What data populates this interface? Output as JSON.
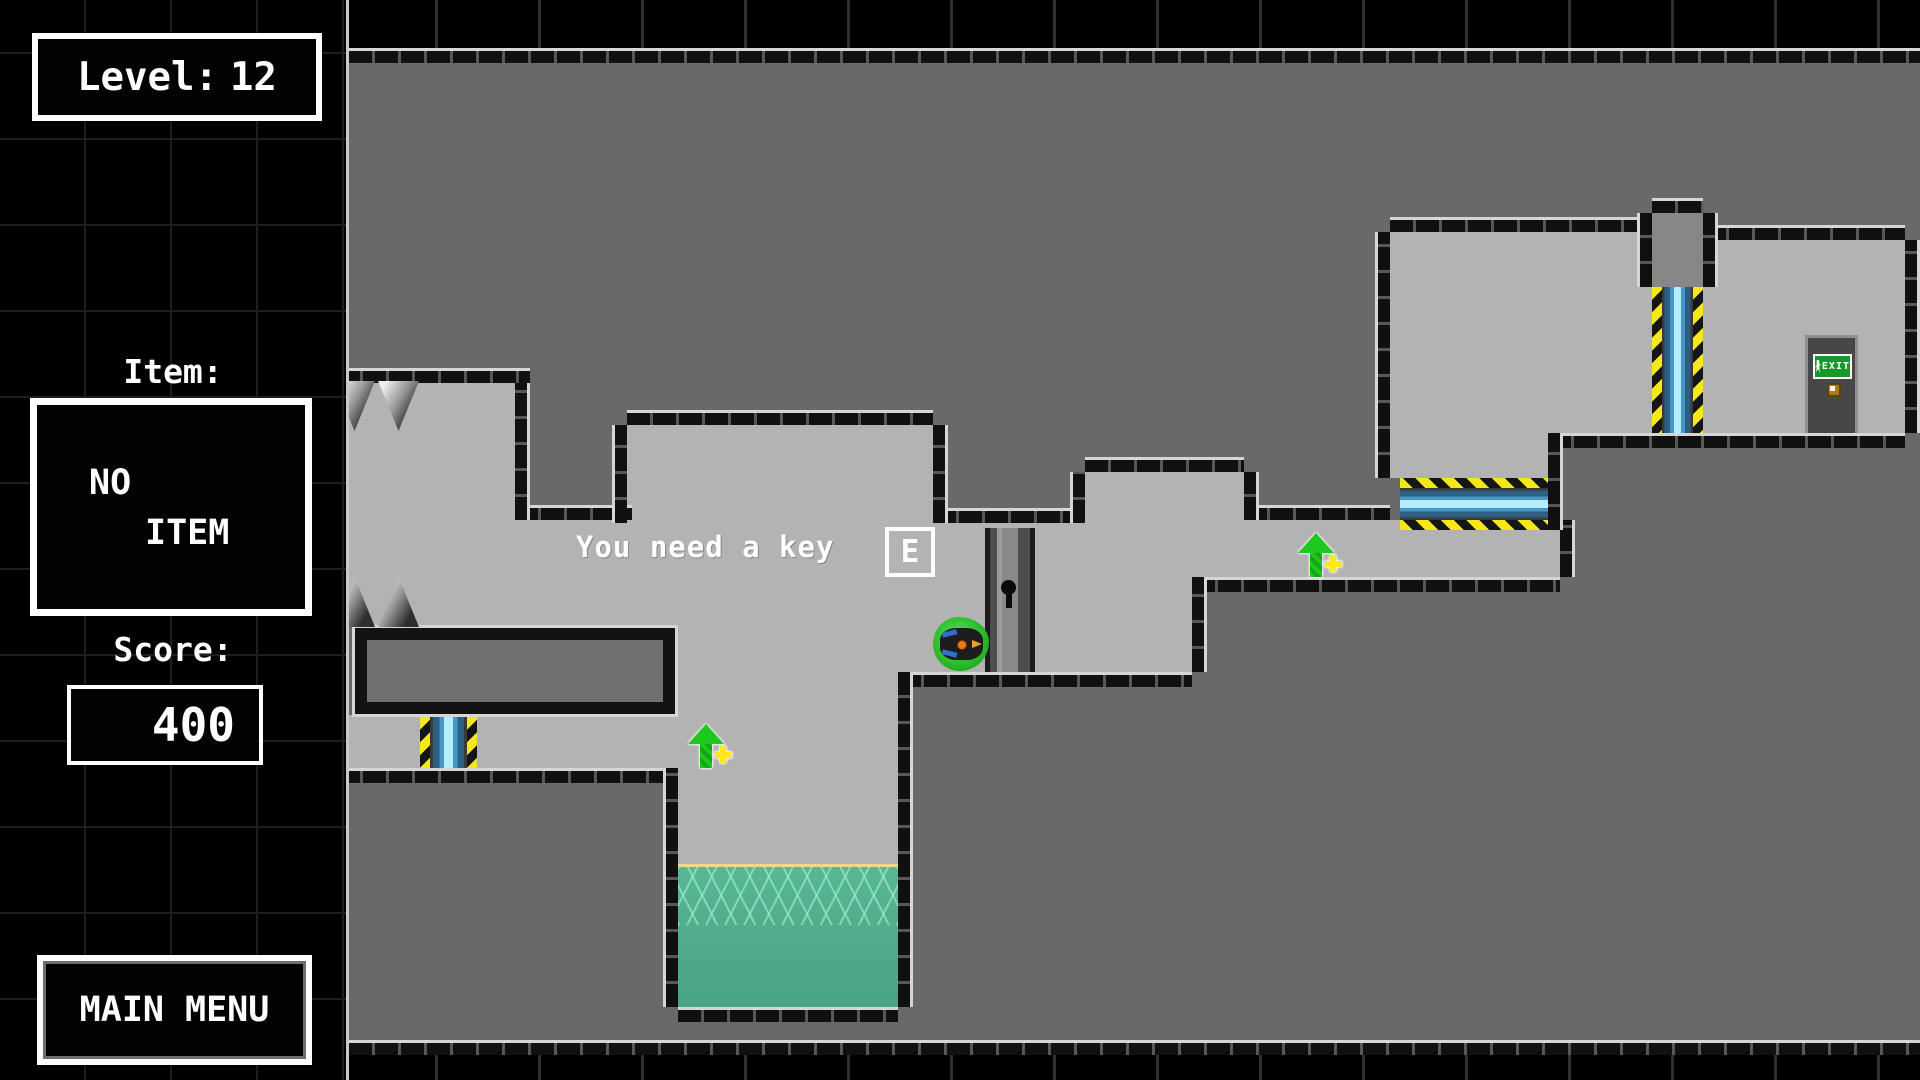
{
  "sidebar": {
    "level": {
      "label": "Level:",
      "value": "12"
    },
    "item": {
      "label": "Item:",
      "value_line1": "NO",
      "value_line2": "ITEM"
    },
    "score": {
      "label": "Score:",
      "value": "400"
    },
    "menu_button_label": "MAIN MENU"
  },
  "hud": {
    "message": "You need a key",
    "key_prompt": "E"
  },
  "game": {
    "exit_sign_text": "EXIT"
  },
  "colors": {
    "hazard_yellow": "#f5e81a",
    "laser_blue": "#b5eeff",
    "water_teal": "#4fae8e",
    "player_green": "#2ec52e",
    "open_gray": "#b3b3b3",
    "wall_gray": "#696969",
    "hud_white": "#ffffff"
  }
}
